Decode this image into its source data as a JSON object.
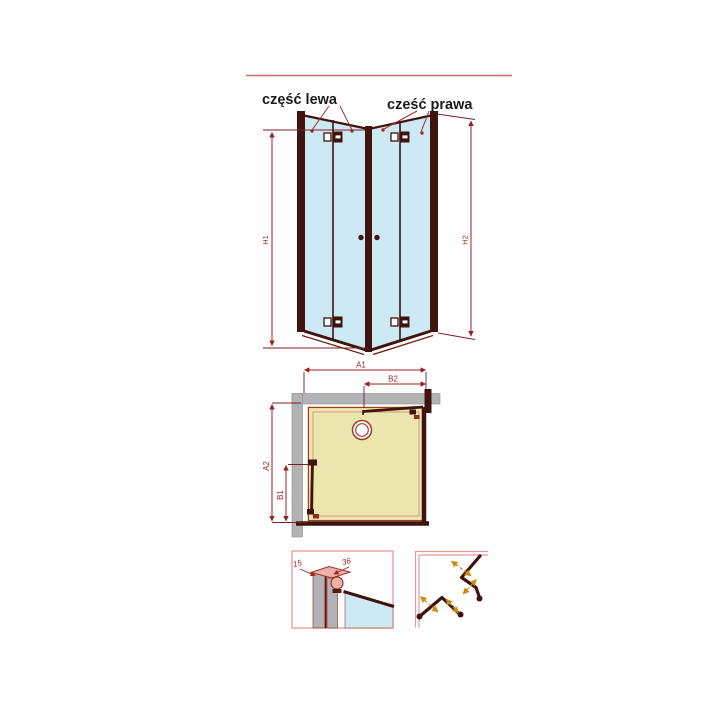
{
  "title_labels": {
    "left": "część lewa",
    "right": "cześć prawa"
  },
  "elevation": {
    "height_left": "H1",
    "height_right": "H2"
  },
  "plan": {
    "width_total": "A1",
    "width_right_part": "B2",
    "depth_total": "A2",
    "depth_left_part": "B1"
  },
  "profile_detail": {
    "dim_inner": "15",
    "dim_outer": "36"
  },
  "colors": {
    "frame_dark": "#3f140e",
    "frame_rim": "#7a2417",
    "glass_blue": "#cde9f4",
    "dimension_red": "#9c1f1f",
    "rule_red": "#c4706d",
    "wall_gray": "#b3b3b7",
    "tray_yellow": "#ece5ad",
    "tray_outline": "#9c4030",
    "detail_border_pink": "#e8989a",
    "fold_arrow_orange": "#cf8a12",
    "cap_pink": "#e9b2aa",
    "label_black": "#1a1a1a"
  }
}
